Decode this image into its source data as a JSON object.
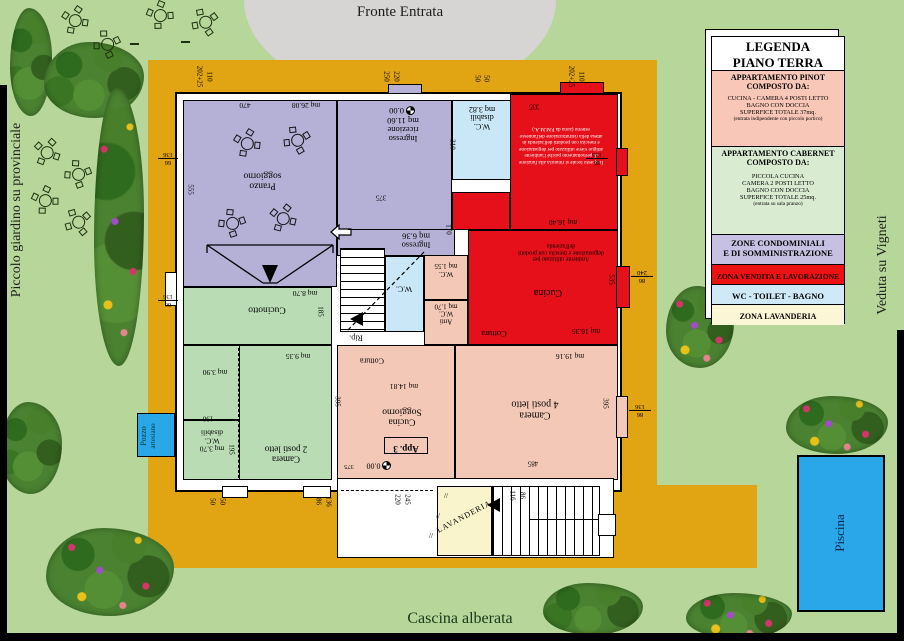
{
  "labels": {
    "fronte_entrata": "Fronte Entrata",
    "cascina_alberata": "Cascina alberata",
    "piccolo_giardino": "Piccolo giardino su provinciale",
    "veduta_vigneti": "Veduta su Vigneti",
    "piscina": "Piscina",
    "pozzo_l1": "Pozzo",
    "pozzo_l2": "artesiano"
  },
  "legend": {
    "title1": "LEGENDA",
    "title2": "PIANO TERRA",
    "pinot_h1": "APPARTAMENTO  PINOT",
    "pinot_h2": "COMPOSTO DA:",
    "pinot_b1": "CUCINA - CAMERA 4 POSTI LETTO",
    "pinot_b2": "BAGNO CON DOCCIA",
    "pinot_b3": "SUPERFICE TOTALE 37mq.",
    "pinot_note": "(entrata indipendente con piccolo portico)",
    "cab_h1": "APPARTAMENTO  CABERNET",
    "cab_h2": "COMPOSTO DA:",
    "cab_b1": "PICCOLA CUCINA",
    "cab_b2": "CAMERA 2 POSTI LETTO",
    "cab_b3": "BAGNO CON DOCCIA",
    "cab_b4": "SUPERFICE TOTALE 25mq.",
    "cab_note": "(entrata su sala pranzo)",
    "cond_1": "ZONE CONDOMINIALI",
    "cond_2": "E DI SOMMINISTRAZIONE",
    "vendita": "ZONA VENDITA E LAVORAZIONE",
    "wc": "WC - TOILET - BAGNO",
    "lav": "ZONA LAVANDERIA"
  },
  "rooms": {
    "pranzo_l1": "Pranzo",
    "pranzo_l2": "soggiorno",
    "pranzo_mq": "mq 26.08",
    "ricez_l1": "Ingresso",
    "ricez_l2": "ricezione",
    "ricez_mq": "mq 11.60",
    "ricez_datum": "0.00",
    "ingresso_l1": "Ingresso",
    "ingresso_mq": "mq 6.36",
    "wc_dis_top_l1": "W.C.",
    "wc_dis_top_l2": "disabili",
    "wc_dis_top_mq": "mq 3.82",
    "vendita_text": "In questo locale si rinuncia alla funzione di pernottamento poiché l'ambiente attiguo viene utilizzato per degustazione e mescita con prodotti dell'azienda in attesa della ristrutturazione dell'annesso esterno (zona da P.M.M.A.)",
    "vendita_mq": "mq 16.40",
    "cucina_name": "Cucina",
    "cucina_text": "Ambiente utilizzato per degustazione e mescita con prodotti dell'azienda",
    "cucina_mq": "mq 16.35",
    "cottura_red": "Cottura",
    "wc155_l1": "W.C.",
    "wc155_mq": "mq 1.55",
    "antiwc_l1": "Anti",
    "antiwc_l2": "W.C.",
    "antiwc_mq": "mq 1.70",
    "wc_stair": "W.C.",
    "rip": "Rip.",
    "cucinotto": "Cucinotto",
    "cucinotto_mq": "mq 8.70",
    "camera2_l1": "Camera",
    "camera2_l2": "2 posti letto",
    "camera2_mq": "mq 9.35",
    "r390_mq": "mq 3.90",
    "wc_green_mq": "mq 3.70",
    "wc_green_l1": "W.C.",
    "wc_green_l2": "disabili",
    "cottura_pink": "Cottura",
    "app3_mq": "mq 14.81",
    "app3_l1": "Cucina",
    "app3_l2": "Soggiorno",
    "app3_tag": "App. 3",
    "app3_datum": "0.00",
    "camera4_l1": "Camera",
    "camera4_l2": "4 posti letto",
    "camera4_mq": "mq 19.16",
    "lavanderia": "LAVANDERIA",
    "hatch": "//"
  },
  "dims": {
    "t1a": "202+25",
    "t1b": "110",
    "t2a": "250",
    "t2b": "220",
    "t3a": "50",
    "t3b": "50",
    "t4a": "202+25",
    "t4b": "110",
    "l1n": "66",
    "l1d": "136",
    "l2n": "66",
    "l2d": "136",
    "v555": "555",
    "r1n": "86",
    "r1d": "136",
    "r2n": "86",
    "r2d": "240",
    "r3n": "86",
    "r3d": "136",
    "v310": "310",
    "v170": "170",
    "v140": "140",
    "v535": "535",
    "d335": "335",
    "v185": "185",
    "d190": "190",
    "v195": "195",
    "v395a": "395",
    "v395b": "395",
    "d375a": "375",
    "d375b": "375",
    "d470": "470",
    "d485": "485",
    "b1a": "50",
    "b1b": "50",
    "b2a": "86",
    "b2b": "136",
    "b3a": "220",
    "b3b": "245",
    "b4a": "116",
    "b4b": "86"
  },
  "colors": {
    "garden": "#b7d79a",
    "courtyard": "#e1a413",
    "driveway": "#d6d5d3",
    "condominiali": "#b5b1d6",
    "cabernet": "#b9dcb5",
    "pinot": "#f4c8b6",
    "vendita": "#e51019",
    "wc": "#c9e7f7",
    "lavanderia": "#f9f4cc",
    "pool": "#2aa7e8"
  }
}
